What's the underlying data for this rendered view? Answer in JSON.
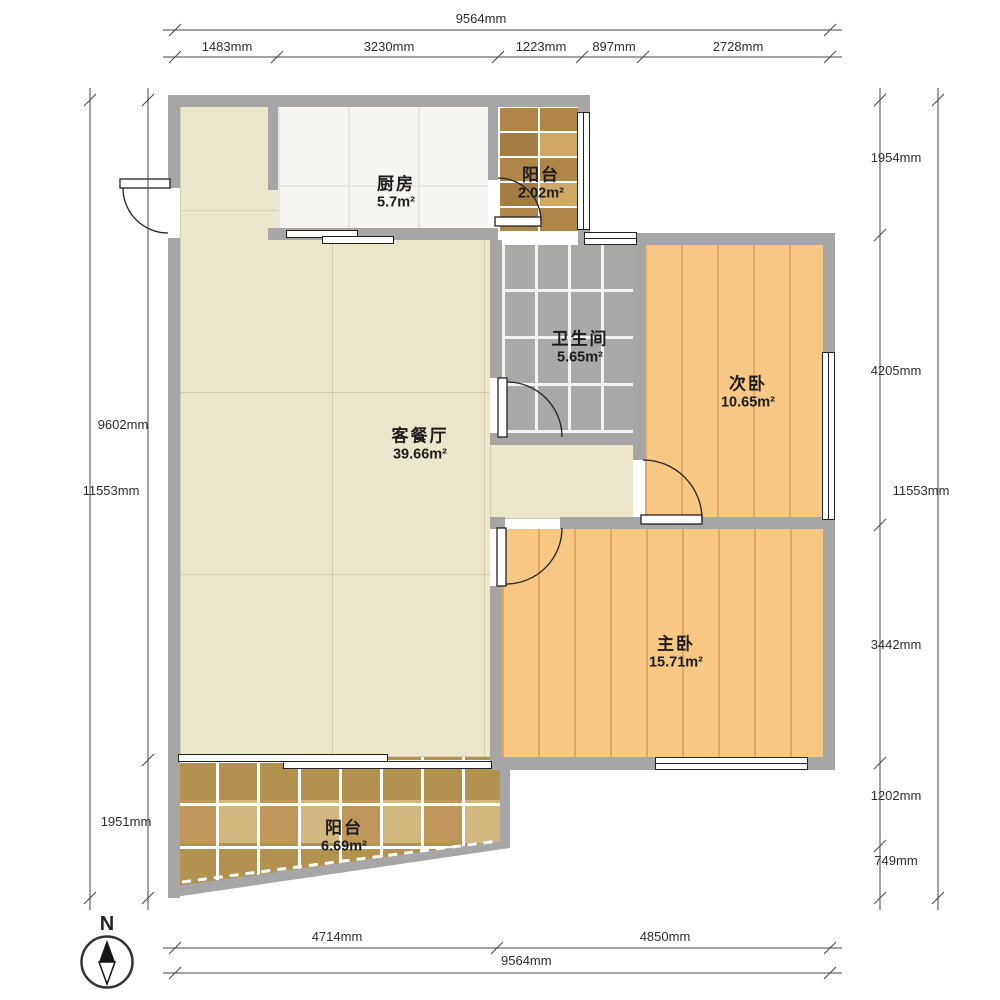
{
  "title": "户型图",
  "compass": {
    "label": "N"
  },
  "rooms": [
    {
      "id": "kitchen",
      "name": "厨房",
      "area": "5.7m²"
    },
    {
      "id": "balcony-top",
      "name": "阳台",
      "area": "2.02m²"
    },
    {
      "id": "bathroom",
      "name": "卫生间",
      "area": "5.65m²"
    },
    {
      "id": "bedroom-second",
      "name": "次卧",
      "area": "10.65m²"
    },
    {
      "id": "living-dining",
      "name": "客餐厅",
      "area": "39.66m²"
    },
    {
      "id": "bedroom-master",
      "name": "主卧",
      "area": "15.71m²"
    },
    {
      "id": "balcony-bottom",
      "name": "阳台",
      "area": "6.69m²"
    }
  ],
  "dimensions": {
    "top": {
      "total": "9564mm",
      "segments": [
        "1483mm",
        "3230mm",
        "1223mm",
        "897mm",
        "2728mm"
      ]
    },
    "bottom": {
      "total": "9564mm",
      "segments": [
        "4714mm",
        "4850mm"
      ]
    },
    "left": {
      "total": "11553mm",
      "segments": [
        "9602mm",
        "1951mm"
      ]
    },
    "right": {
      "total": "11553mm",
      "segments": [
        "1954mm",
        "4205mm",
        "3442mm",
        "1202mm",
        "749mm"
      ]
    }
  },
  "colors": {
    "wall": "#a6a6a6",
    "floor-living": "#eae7cb",
    "floor-wood": "#f6c883",
    "floor-kitchen": "#f6f5f1",
    "floor-bath": "#a9a9a7",
    "line": "#444444",
    "text": "#1c1c1c"
  }
}
